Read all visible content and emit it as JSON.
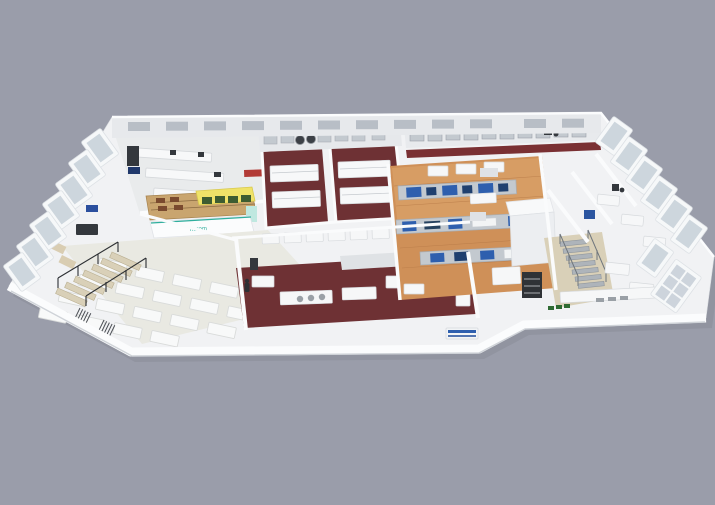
{
  "scene": {
    "description": "Isometric 3D cutaway render of a single-storey laboratory and pilot-production facility floor plan on a plain gray background",
    "features": [
      "open seating area with rows of white tables",
      "retail display kiosk with yellow canopy and green shelf boxes",
      "wet-lab rooms with dark maroon floors and white island benches",
      "pilot production hall with wood floor and blue machine lines",
      "instrument labs along tilted perimeter display windows",
      "two staircases",
      "rear wall with ribbon windows"
    ],
    "counts": {
      "left_window_frames": 7,
      "right_window_frames": 7,
      "rear_wall_windows": 12,
      "cafeteria_table_rows": 4,
      "maroon_lab_rooms": 3,
      "production_lines": 3,
      "staircases": 2
    }
  },
  "branding": {
    "kiosk_logo_text": "hurom"
  },
  "palette": {
    "background": "#9a9daa",
    "shadow": "#80848f",
    "building": "#f1f2f4",
    "wall_bright": "#fbfcfd",
    "wall_shade": "#e7e9ec",
    "wall_edge": "#cfd3d8",
    "floor_pale": "#e9e9e2",
    "floor_maroon": "#6e3134",
    "maroon_strip": "#7a3033",
    "floor_wood": "#cf9058",
    "floor_wood_light": "#dfa76f",
    "floor_tan": "#d9d0b8",
    "kiosk_yellow": "#efe268",
    "kiosk_green": "#3d5c31",
    "kiosk_wood": "#c9a56f",
    "accent_teal": "#2fae9d",
    "machine_blue": "#2e5fae",
    "machine_navy": "#20406f",
    "steel": "#c3c9cf",
    "steel_dark": "#9ba1a8",
    "equipment_dark": "#34383d",
    "glass": "#c9d1d9",
    "window_frame": "#f6f8f9",
    "accent_red": "#b23b36",
    "table_white": "#f8f9f9"
  }
}
